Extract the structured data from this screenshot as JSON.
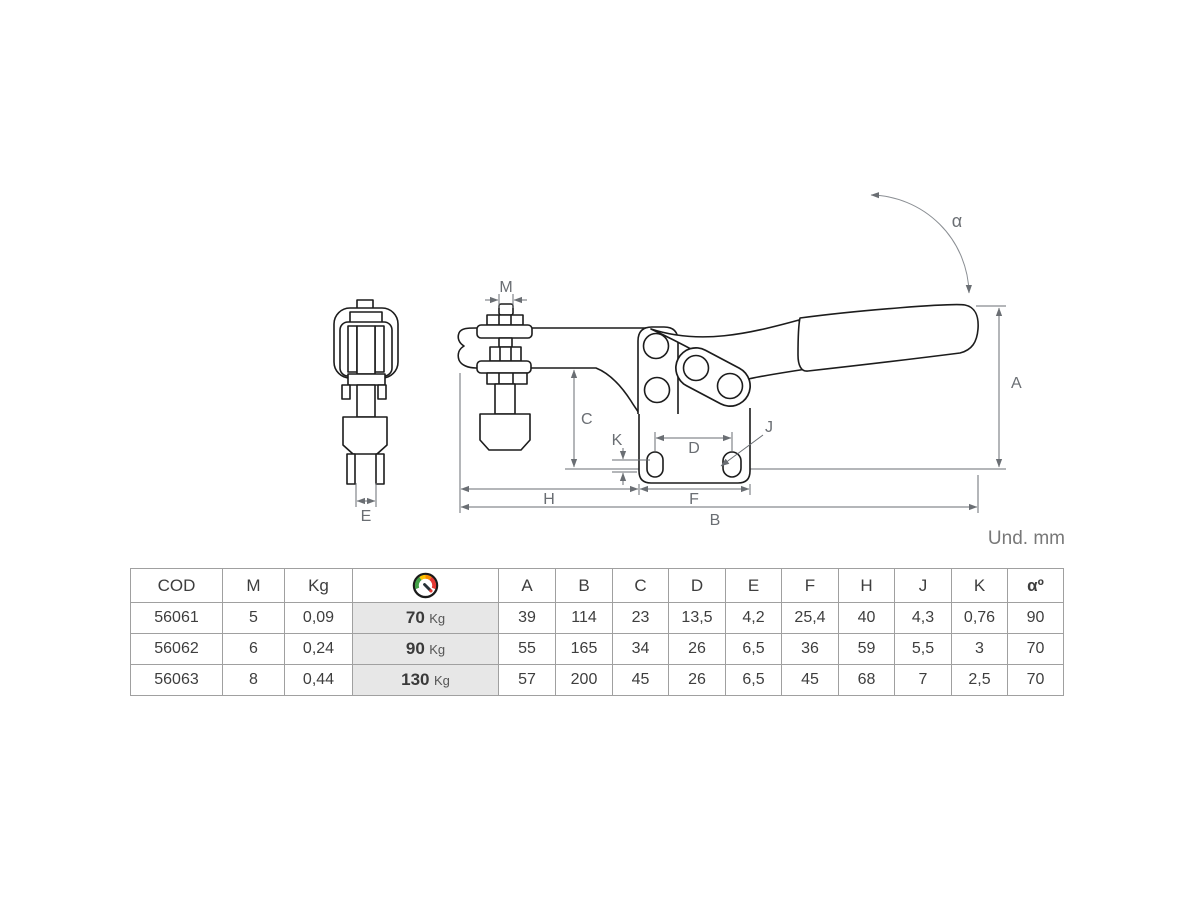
{
  "page": {
    "units_label": "Und. mm"
  },
  "drawing": {
    "labels": {
      "M": "M",
      "E": "E",
      "C": "C",
      "K": "K",
      "D": "D",
      "J": "J",
      "H": "H",
      "F": "F",
      "B": "B",
      "A": "A",
      "alpha": "α"
    }
  },
  "table": {
    "headers": {
      "cod": "COD",
      "m": "M",
      "kg": "Kg",
      "a": "A",
      "b": "B",
      "c": "C",
      "d": "D",
      "e": "E",
      "f": "F",
      "h": "H",
      "j": "J",
      "k": "K",
      "alpha": "αº"
    },
    "rows": [
      {
        "cod": "56061",
        "m": "5",
        "kg": "0,09",
        "force": "70",
        "force_unit": "Kg",
        "a": "39",
        "b": "114",
        "c": "23",
        "d": "13,5",
        "e": "4,2",
        "f": "25,4",
        "h": "40",
        "j": "4,3",
        "k": "0,76",
        "alpha": "90"
      },
      {
        "cod": "56062",
        "m": "6",
        "kg": "0,24",
        "force": "90",
        "force_unit": "Kg",
        "a": "55",
        "b": "165",
        "c": "34",
        "d": "26",
        "e": "6,5",
        "f": "36",
        "h": "59",
        "j": "5,5",
        "k": "3",
        "alpha": "70"
      },
      {
        "cod": "56063",
        "m": "8",
        "kg": "0,44",
        "force": "130",
        "force_unit": "Kg",
        "a": "57",
        "b": "200",
        "c": "45",
        "d": "26",
        "e": "6,5",
        "f": "45",
        "h": "68",
        "j": "7",
        "k": "2,5",
        "alpha": "70"
      }
    ]
  },
  "colors": {
    "outline": "#1c1c1c",
    "dimension": "#6a6e73",
    "table_border": "#a0a0a0",
    "force_bg": "#e7e7e7",
    "gauge_green": "#43a047",
    "gauge_yellow": "#fdc500",
    "gauge_orange": "#fb8c00",
    "gauge_red": "#e53935"
  }
}
